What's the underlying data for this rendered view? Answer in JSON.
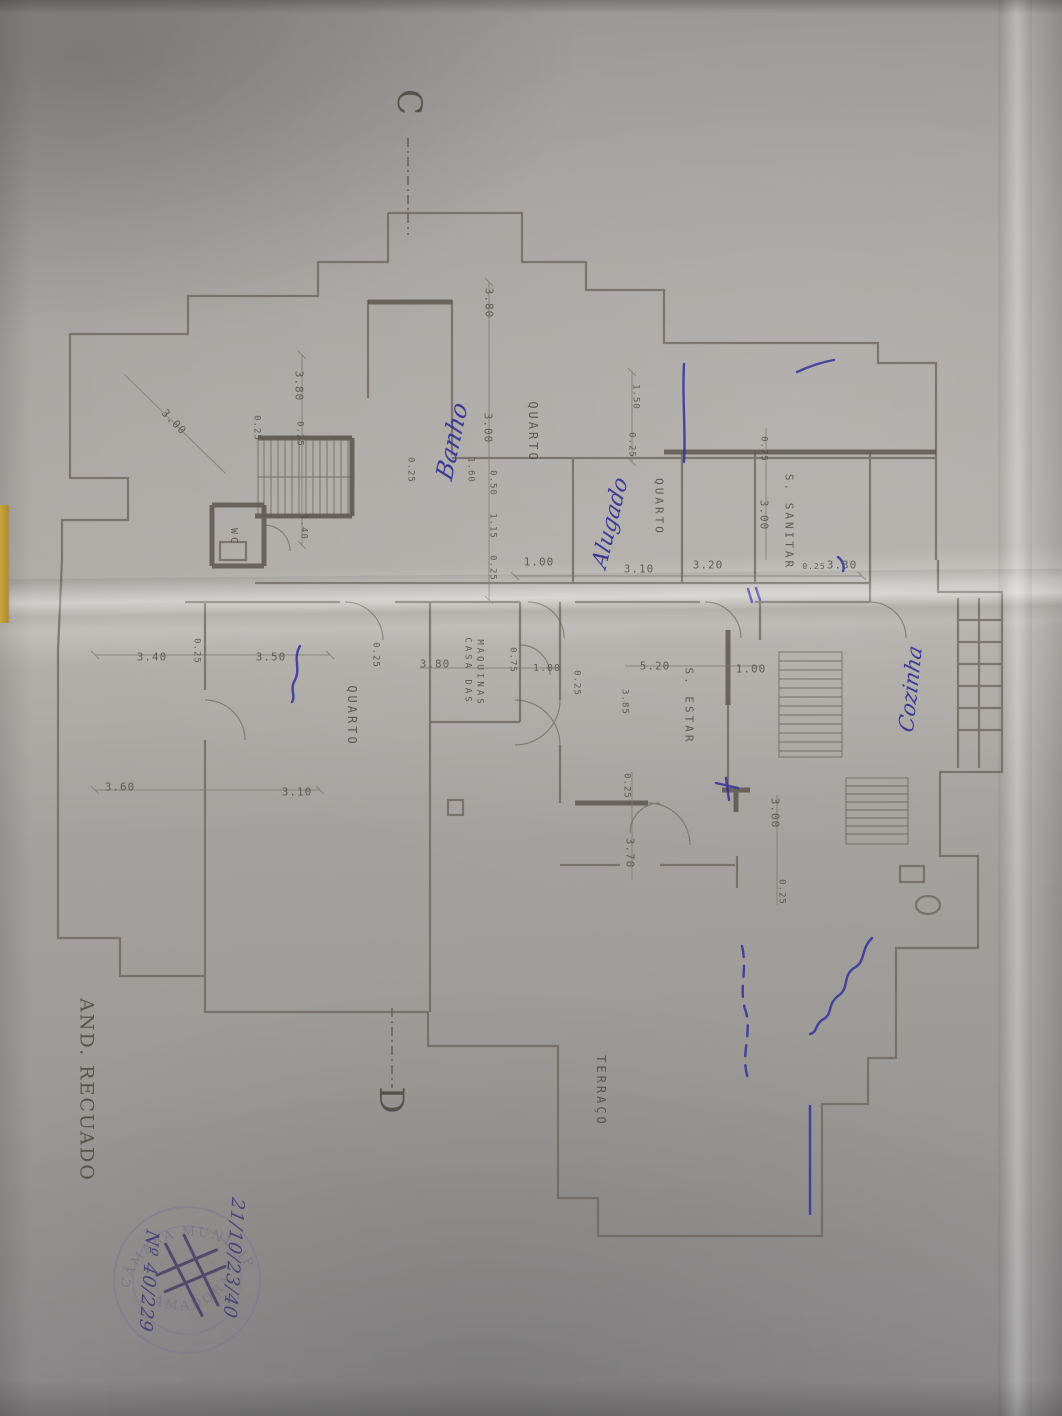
{
  "document": {
    "kind": "photograph of an architectural floor plan (blueprint copy), sheet rotated 90°",
    "floor_note": "AND. RECUADO",
    "section_markers": {
      "top": "C",
      "bottom": "D"
    }
  },
  "rooms": [
    "QUARTO",
    "QUARTO",
    "S. SANITAR",
    "QUARTO",
    "S. ESTAR",
    "CASA DAS MÁQUINAS",
    "WC",
    "TERRAÇO"
  ],
  "handwritten_notes": [
    "Banho",
    "Alugado",
    "Cozinha",
    "21/10/23/40",
    "Nº 40/229"
  ],
  "dimensions_shown": [
    "3.80",
    "3.00",
    "0.25",
    "1.60",
    "0.50",
    "1.15",
    "1.40",
    "1.50",
    "0.75",
    "1.00",
    "3.10",
    "3.20",
    "3.30",
    "3.40",
    "3.50",
    "3.60",
    "3.70",
    "3.85",
    "5.20"
  ],
  "stamp": {
    "ring_top": "CÂMARA MUNICIPAL",
    "ring_bottom": "AMADORA",
    "center": "rubrica"
  },
  "colors": {
    "paper": "#a5a2a0",
    "plan_line": "#57524b",
    "blue_ink": "#2f2e95",
    "stamp": "#776f83",
    "yellow_edge": "#c9a53e"
  },
  "labels": [
    {
      "name": "dim-3-80-a",
      "text": "3.80",
      "x": 489,
      "y": 303,
      "rot": 90,
      "size": 11,
      "cls": "dim"
    },
    {
      "name": "dim-3-00-diag",
      "text": "3.00",
      "x": 174,
      "y": 422,
      "rot": 46,
      "size": 11,
      "cls": "dim"
    },
    {
      "name": "dim-3-80-b",
      "text": "3.80",
      "x": 299,
      "y": 386,
      "rot": 90,
      "size": 11,
      "cls": "dim"
    },
    {
      "name": "dim-0-25-a",
      "text": "0.25",
      "x": 299,
      "y": 434,
      "rot": 90,
      "size": 9,
      "cls": "dim"
    },
    {
      "name": "dim-0-25-b",
      "text": "0.25",
      "x": 256,
      "y": 428,
      "rot": 90,
      "size": 9,
      "cls": "dim"
    },
    {
      "name": "dim-0-25-c",
      "text": "0.25",
      "x": 410,
      "y": 470,
      "rot": 90,
      "size": 9,
      "cls": "dim"
    },
    {
      "name": "dim-3-00-a",
      "text": "3.00",
      "x": 488,
      "y": 428,
      "rot": 90,
      "size": 11,
      "cls": "dim"
    },
    {
      "name": "dim-1-60",
      "text": "1.60",
      "x": 470,
      "y": 470,
      "rot": 90,
      "size": 9,
      "cls": "dim"
    },
    {
      "name": "dim-0-50",
      "text": "0.50",
      "x": 492,
      "y": 483,
      "rot": 90,
      "size": 9,
      "cls": "dim"
    },
    {
      "name": "dim-1-15",
      "text": "1.15",
      "x": 492,
      "y": 526,
      "rot": 90,
      "size": 9,
      "cls": "dim"
    },
    {
      "name": "dim-0-25-d",
      "text": "0.25",
      "x": 492,
      "y": 568,
      "rot": 90,
      "size": 9,
      "cls": "dim"
    },
    {
      "name": "dim-1-40",
      "text": "1.40",
      "x": 303,
      "y": 527,
      "rot": 90,
      "size": 9,
      "cls": "dim"
    },
    {
      "name": "dim-1-50",
      "text": "1.50",
      "x": 635,
      "y": 397,
      "rot": 90,
      "size": 9,
      "cls": "dim"
    },
    {
      "name": "dim-0-25-e",
      "text": "0.25",
      "x": 631,
      "y": 445,
      "rot": 90,
      "size": 9,
      "cls": "dim"
    },
    {
      "name": "dim-0-75-a",
      "text": "0.75",
      "x": 763,
      "y": 449,
      "rot": 90,
      "size": 9,
      "cls": "dim"
    },
    {
      "name": "dim-3-00-b",
      "text": "3.00",
      "x": 764,
      "y": 515,
      "rot": 90,
      "size": 11,
      "cls": "dim"
    },
    {
      "name": "dim-1-00-a",
      "text": "1.00",
      "x": 539,
      "y": 562,
      "rot": 0,
      "size": 11,
      "cls": "dim"
    },
    {
      "name": "dim-3-10-a",
      "text": "3.10",
      "x": 639,
      "y": 569,
      "rot": 0,
      "size": 11,
      "cls": "dim"
    },
    {
      "name": "dim-3-20",
      "text": "3.20",
      "x": 708,
      "y": 565,
      "rot": 0,
      "size": 11,
      "cls": "dim"
    },
    {
      "name": "dim-0-25-f",
      "text": "0.25",
      "x": 814,
      "y": 567,
      "rot": 0,
      "size": 8,
      "cls": "dim"
    },
    {
      "name": "dim-3-30",
      "text": "3.30",
      "x": 842,
      "y": 565,
      "rot": 0,
      "size": 11,
      "cls": "dim"
    },
    {
      "name": "dim-3-40",
      "text": "3.40",
      "x": 152,
      "y": 657,
      "rot": 0,
      "size": 11,
      "cls": "dim"
    },
    {
      "name": "dim-0-25-g",
      "text": "0.25",
      "x": 196,
      "y": 651,
      "rot": 90,
      "size": 9,
      "cls": "dim"
    },
    {
      "name": "dim-3-50",
      "text": "3.50",
      "x": 271,
      "y": 657,
      "rot": 0,
      "size": 11,
      "cls": "dim"
    },
    {
      "name": "dim-0-25-h",
      "text": "0.25",
      "x": 375,
      "y": 655,
      "rot": 90,
      "size": 9,
      "cls": "dim"
    },
    {
      "name": "dim-3-80-c",
      "text": "3.80",
      "x": 435,
      "y": 664,
      "rot": 0,
      "size": 11,
      "cls": "dim"
    },
    {
      "name": "dim-0-75-b",
      "text": "0.75",
      "x": 512,
      "y": 660,
      "rot": 90,
      "size": 9,
      "cls": "dim"
    },
    {
      "name": "dim-1-00-b",
      "text": "1.00",
      "x": 547,
      "y": 669,
      "rot": 0,
      "size": 10,
      "cls": "dim"
    },
    {
      "name": "dim-0-25-i",
      "text": "0.25",
      "x": 576,
      "y": 683,
      "rot": 90,
      "size": 9,
      "cls": "dim"
    },
    {
      "name": "dim-5-20",
      "text": "5.20",
      "x": 655,
      "y": 666,
      "rot": 0,
      "size": 11,
      "cls": "dim"
    },
    {
      "name": "dim-1-00-c",
      "text": "1.00",
      "x": 751,
      "y": 669,
      "rot": 0,
      "size": 11,
      "cls": "dim"
    },
    {
      "name": "dim-3-85",
      "text": "3.85",
      "x": 624,
      "y": 702,
      "rot": 90,
      "size": 9,
      "cls": "dim"
    },
    {
      "name": "dim-3-60",
      "text": "3.60",
      "x": 120,
      "y": 787,
      "rot": 0,
      "size": 11,
      "cls": "dim"
    },
    {
      "name": "dim-3-10-b",
      "text": "3.10",
      "x": 297,
      "y": 792,
      "rot": 0,
      "size": 11,
      "cls": "dim"
    },
    {
      "name": "dim-0-25-j",
      "text": "0.25",
      "x": 626,
      "y": 786,
      "rot": 90,
      "size": 9,
      "cls": "dim"
    },
    {
      "name": "dim-3-70",
      "text": "3.70",
      "x": 630,
      "y": 853,
      "rot": 90,
      "size": 11,
      "cls": "dim"
    },
    {
      "name": "dim-3-00-c",
      "text": "3.00",
      "x": 775,
      "y": 813,
      "rot": 90,
      "size": 11,
      "cls": "dim"
    },
    {
      "name": "dim-0-25-k",
      "text": "0.25",
      "x": 781,
      "y": 892,
      "rot": 90,
      "size": 9,
      "cls": "dim"
    },
    {
      "name": "room-label-quarto-1",
      "text": "QUARTO",
      "x": 533,
      "y": 432,
      "rot": 90,
      "size": 12,
      "cls": "room"
    },
    {
      "name": "room-label-quarto-2",
      "text": "QUARTO",
      "x": 659,
      "y": 507,
      "rot": 90,
      "size": 11,
      "cls": "room"
    },
    {
      "name": "room-label-sanitar",
      "text": "S. SANITAR",
      "x": 789,
      "y": 522,
      "rot": 90,
      "size": 11,
      "cls": "room"
    },
    {
      "name": "room-label-quarto-3",
      "text": "QUARTO",
      "x": 352,
      "y": 716,
      "rot": 90,
      "size": 12,
      "cls": "room"
    },
    {
      "name": "room-label-estar",
      "text": "S. ESTAR",
      "x": 689,
      "y": 706,
      "rot": 90,
      "size": 11,
      "cls": "room"
    },
    {
      "name": "room-label-casa-das",
      "text": "CASA DAS",
      "x": 467,
      "y": 671,
      "rot": 90,
      "size": 9,
      "cls": "room"
    },
    {
      "name": "room-label-maquinas",
      "text": "MÁQUINAS",
      "x": 479,
      "y": 673,
      "rot": 90,
      "size": 9,
      "cls": "room"
    },
    {
      "name": "room-label-wc",
      "text": "WC",
      "x": 233,
      "y": 537,
      "rot": 90,
      "size": 10,
      "cls": "room"
    },
    {
      "name": "room-label-terraco",
      "text": "TERRAÇO",
      "x": 601,
      "y": 1091,
      "rot": 90,
      "size": 12,
      "cls": "room"
    },
    {
      "name": "section-letter-c",
      "text": "C",
      "x": 409,
      "y": 103,
      "rot": 90,
      "size": 34,
      "cls": "pencil"
    },
    {
      "name": "section-letter-d",
      "text": "D",
      "x": 391,
      "y": 1101,
      "rot": 90,
      "size": 34,
      "cls": "pencil"
    },
    {
      "name": "floor-note",
      "text": "AND. RECUADO",
      "x": 86,
      "y": 1090,
      "rot": 90,
      "size": 19,
      "cls": "pencil"
    },
    {
      "name": "note-banho",
      "text": "Banho",
      "x": 452,
      "y": 441,
      "rot": -78,
      "size": 24,
      "cls": "ink",
      "skew": -10
    },
    {
      "name": "note-alugado",
      "text": "Alugado",
      "x": 611,
      "y": 523,
      "rot": -76,
      "size": 22,
      "cls": "ink",
      "skew": -10
    },
    {
      "name": "note-cozinha",
      "text": "Cozinha",
      "x": 911,
      "y": 689,
      "rot": -84,
      "size": 21,
      "cls": "ink",
      "skew": -10
    },
    {
      "name": "note-ref-1",
      "text": "21/10/23/40",
      "x": 233,
      "y": 1258,
      "rot": 94,
      "size": 18,
      "cls": "ink-ref",
      "skew": -8
    },
    {
      "name": "note-ref-2",
      "text": "Nº 40/229",
      "x": 148,
      "y": 1281,
      "rot": 94,
      "size": 18,
      "cls": "ink-ref",
      "skew": -8
    }
  ]
}
